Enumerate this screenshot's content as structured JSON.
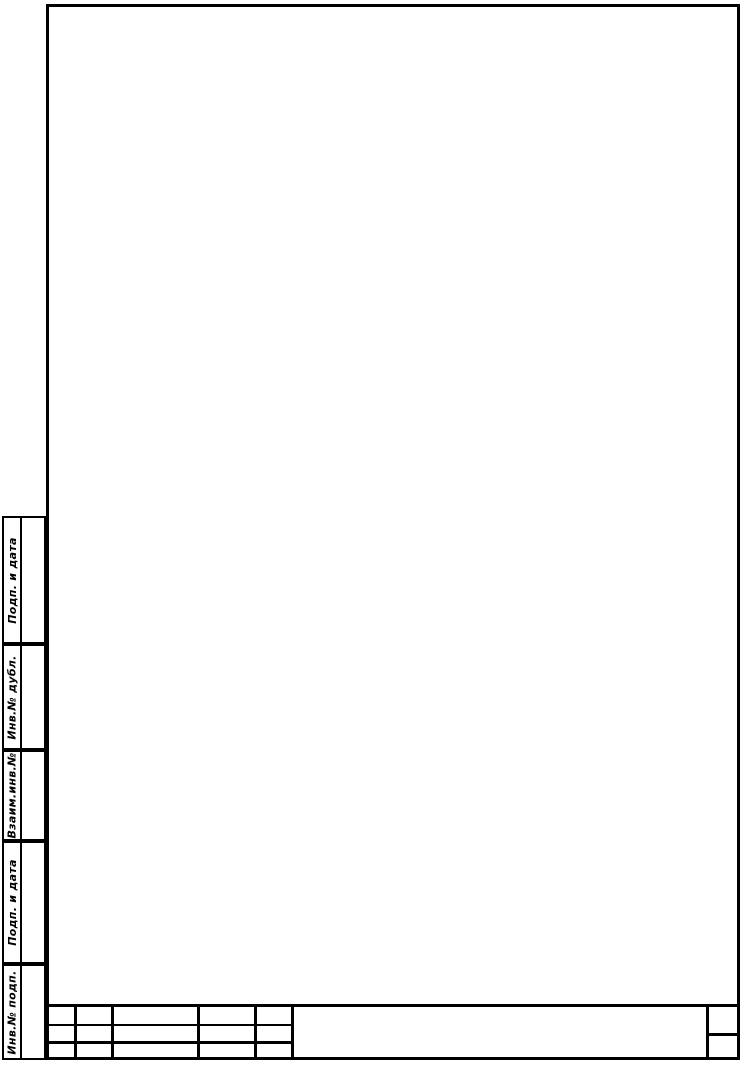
{
  "colors": {
    "paper": "#ffffff",
    "line": "#000000"
  },
  "side_column": {
    "sections": [
      {
        "label": "Подп. и дата"
      },
      {
        "label": "Инв.№ дубл."
      },
      {
        "label": "Взаим.инв.№"
      },
      {
        "label": "Подп. и дата"
      },
      {
        "label": "Инв.№ подп."
      }
    ]
  },
  "title_block": {
    "change_table": {
      "row1": [
        "",
        "",
        "",
        "",
        ""
      ],
      "row2": [
        "",
        "",
        "",
        "",
        ""
      ],
      "row3": [
        "",
        "",
        "",
        "",
        ""
      ]
    },
    "designation_value": "",
    "sheet_label": "",
    "sheet_value": ""
  }
}
